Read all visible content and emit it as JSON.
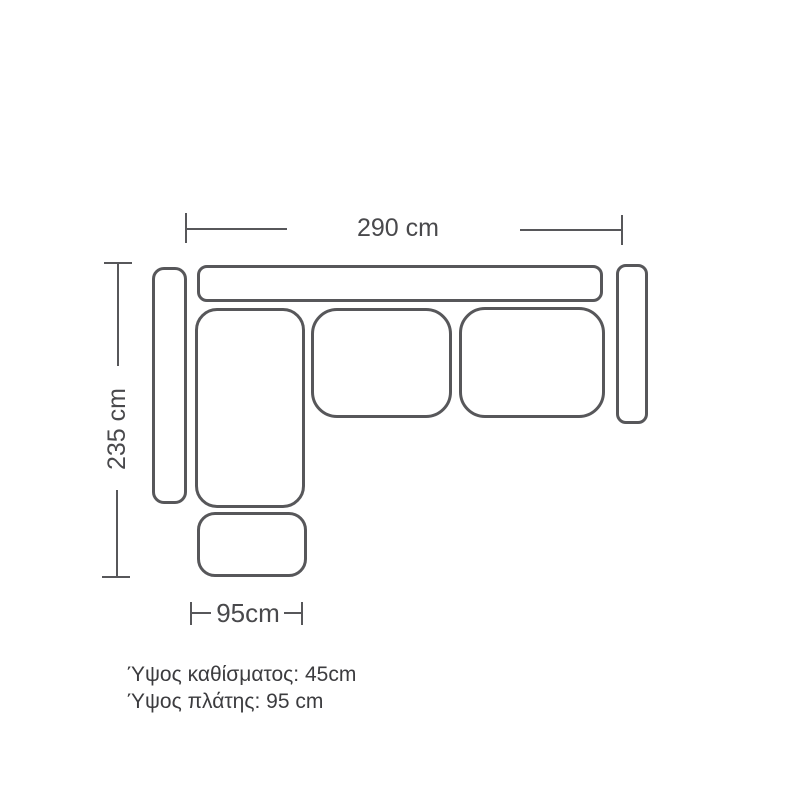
{
  "diagram": {
    "dimensions": {
      "total_width": "290 cm",
      "total_depth": "235 cm",
      "chaise_width": "95cm"
    },
    "notes": {
      "seat_height": "Ύψος καθίσματος: 45cm",
      "back_height": "Ύψος πλάτης: 95 cm"
    },
    "parts": [
      "backrest",
      "left-armrest",
      "right-armrest",
      "chaise-seat",
      "middle-seat-cushion",
      "right-seat-cushion",
      "ottoman"
    ],
    "colors": {
      "outline": "#57575a",
      "dimension_line": "#57575a",
      "dimension_text": "#49494c",
      "note_text": "#3c3c3f",
      "background": "#ffffff"
    }
  }
}
